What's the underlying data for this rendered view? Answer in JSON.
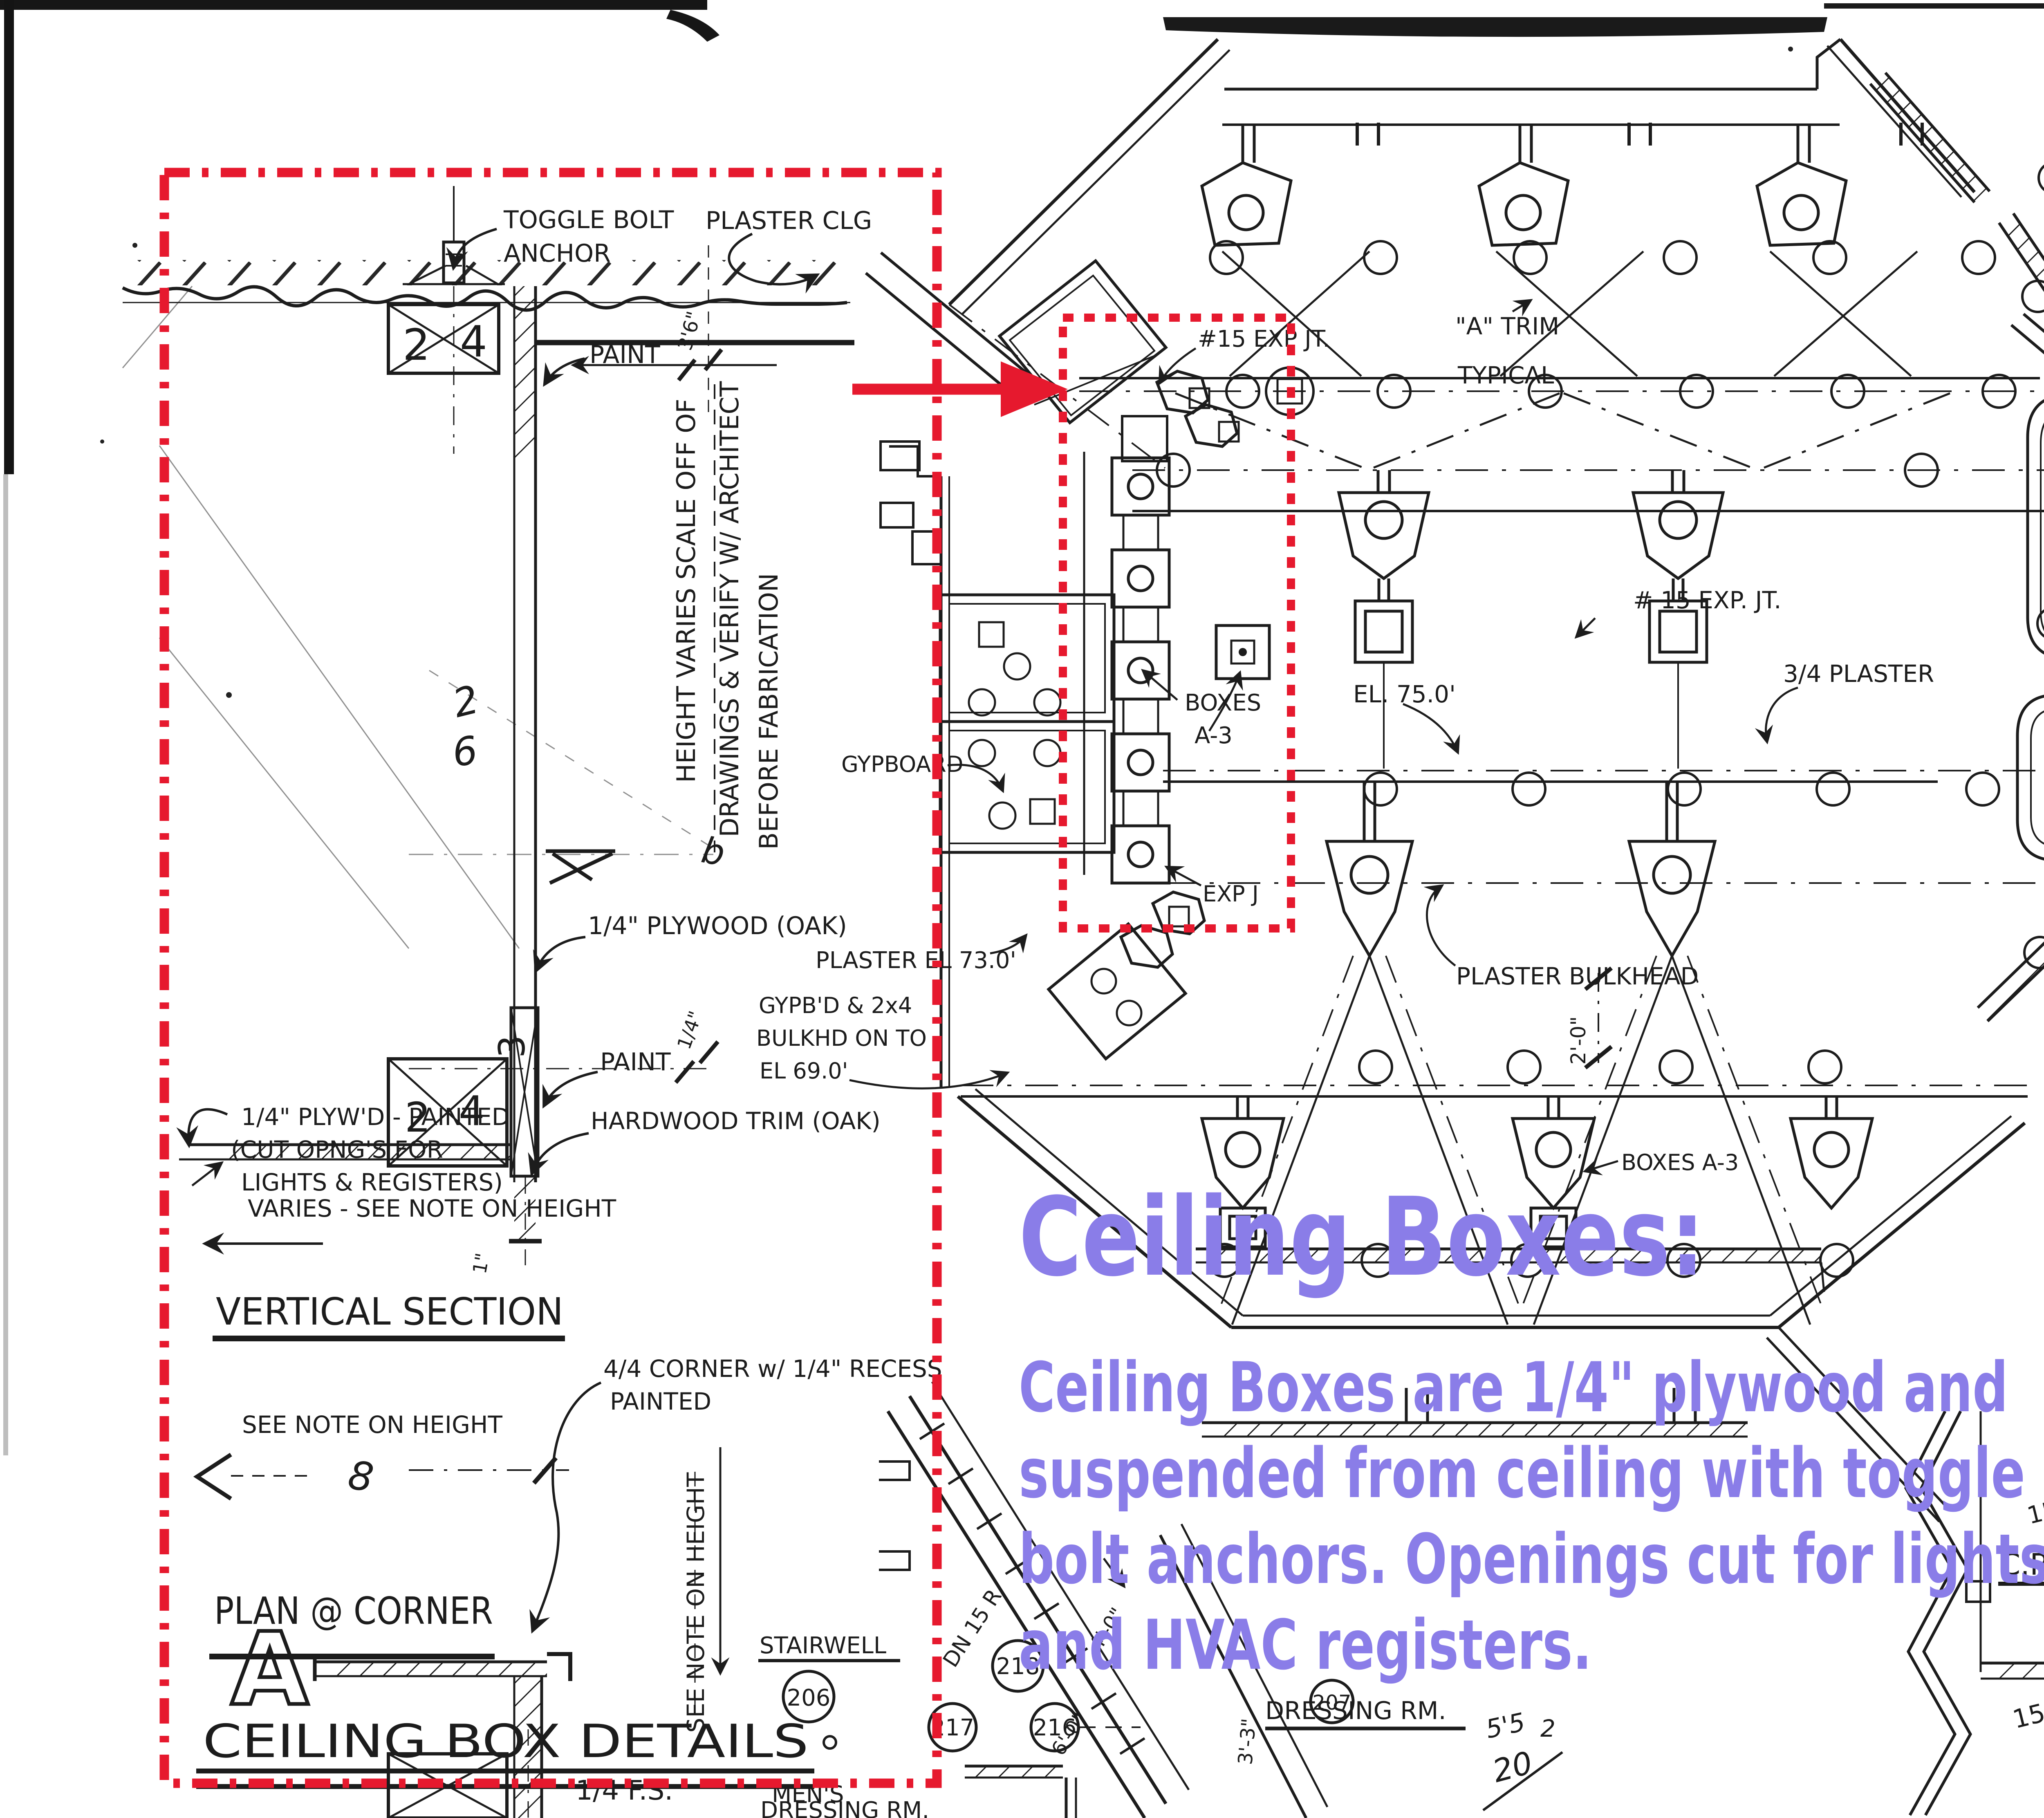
{
  "colors": {
    "markup_red": "#e6192e",
    "overlay_purple": "#8a7de8",
    "ink": "#1c1c1c"
  },
  "overlay": {
    "heading": "Ceiling Boxes:",
    "line1": "Ceiling Boxes are 1/4\" plywood and",
    "line2": "suspended from ceiling with toggle",
    "line3": "bolt anchors.  Openings cut for lights",
    "line4": "and HVAC registers."
  },
  "detail": {
    "toggle_bolt": "TOGGLE BOLT",
    "anchor": "ANCHOR",
    "plaster_clg": "PLASTER CLG",
    "paint": "PAINT",
    "dim_3_6": "3'6\"",
    "height_note_1": "HEIGHT VARIES SCALE OFF OF",
    "height_note_2": "DRAWINGS & VERIFY W/ ARCHITECT",
    "height_note_3": "BEFORE FABRICATION",
    "plywood_oak": "1/4\" PLYWOOD (OAK)",
    "dim_quarter": "1/4\"",
    "plywd_painted_1": "1/4\" PLYW'D - PAINTED",
    "plywd_painted_2": "(CUT OPNG'S FOR",
    "plywd_painted_3": "LIGHTS & REGISTERS)",
    "hardwood_trim": "HARDWOOD TRIM (OAK)",
    "varies_note": "VARIES - SEE NOTE ON HEIGHT",
    "vertical_section": "VERTICAL SECTION",
    "see_note": "SEE NOTE ON HEIGHT",
    "corner_recess_1": "4/4 CORNER w/ 1/4\" RECESS",
    "corner_recess_2": "PAINTED",
    "see_note_vertical": "SEE NOTE ON HEIGHT",
    "dim_1in": "1\"",
    "plan_at_corner": "PLAN @ CORNER",
    "detail_letter": "A",
    "sheet_title": "CEILING BOX DETAILS",
    "sheet_scale": "1/4 F.S.",
    "mark_2": "2",
    "mark_4": "4",
    "mark_3": "3",
    "squiggle_2": "2",
    "squiggle_6": "6",
    "squiggle_8": "8",
    "squiggle_b": "b"
  },
  "plan": {
    "exp_jt_top": "#15 EXP JT.",
    "a_trim_1": "\"A\" TRIM",
    "a_trim_2": "TYPICAL",
    "exp_jt_mid": "# 15 EXP. JT.",
    "boxes_line1": "BOXES",
    "boxes_line2": "A-3",
    "boxes_a3": "BOXES A-3",
    "el_750": "EL. 75.0'",
    "plaster_34": "3/4 PLASTER",
    "gypboard": "GYPBOARD",
    "gypbd_1": "GYPB'D & 2x4",
    "gypbd_2": "BULKHD ON TO",
    "gypbd_3": "EL 69.0'",
    "plaster_el_730": "PLASTER EL 73.0'",
    "exp_j": "EXP J",
    "plaster_bulkhead": "PLASTER BULKHEAD",
    "dim_2_0": "2'-0\"",
    "dn_risers": "DN 15 R",
    "dim_6_0": "6'-0\"",
    "dim_4_0": "4'-0\"",
    "dim_3_3": "3'-3\"",
    "dim_4": "4'.",
    "size_15x22": "15x22",
    "dim_4_4": "4'.4\"",
    "size_15x18": "15x18",
    "scrib_55": "5'5",
    "scrib_2": "2",
    "scrib_20": "20",
    "rooms": {
      "stairwell_name": "STAIRWELL",
      "stairwell_no": "206",
      "dressing_name": "DRESSING RM.",
      "dressing_no": "207",
      "cr_name": "C.R.",
      "cr_no": "208",
      "mens_1": "MEN'S",
      "mens_2": "DRESSING RM.",
      "r216": "216",
      "r217": "217",
      "r218": "218"
    }
  }
}
